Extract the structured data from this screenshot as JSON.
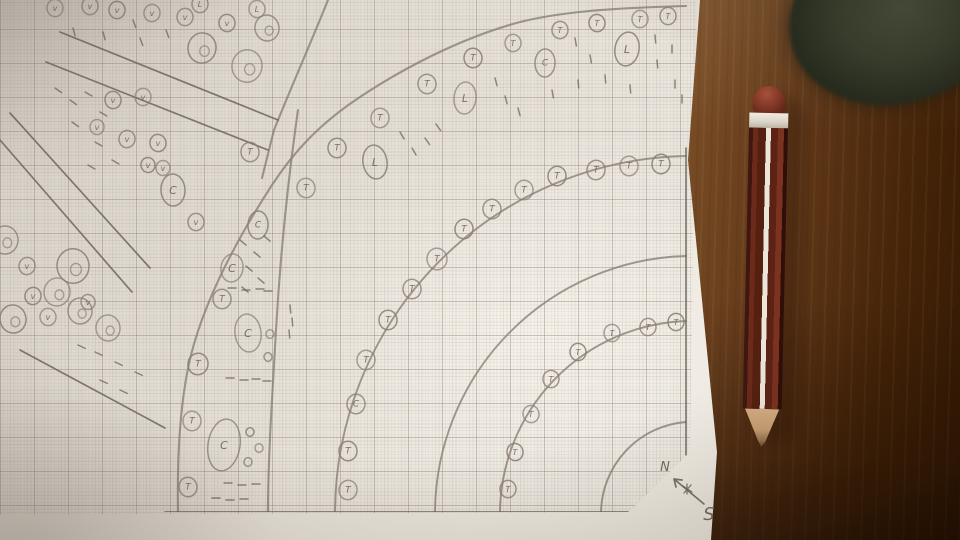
{
  "scene_type": "photo of hand-drawn garden plan on millimeter graph paper with pencil on wooden desk",
  "colors": {
    "pencil_stroke": "#8a8078",
    "pencil_stroke_dark": "#6f665e",
    "letter_color": "#6e655d",
    "paper": "#e7e2d9",
    "wood_light": "#b28a5a",
    "wood_dark": "#3a1d08",
    "pencil_body": "#5c2315",
    "pencil_stripe": "#ece6da",
    "eraser": "#7e3526",
    "wood_tip": "#c79f73"
  },
  "drawing": {
    "compass": {
      "north_label": "N",
      "south_label": "S"
    },
    "fan_center": [
      693,
      514
    ],
    "arc_radii": [
      92,
      193,
      258,
      358
    ],
    "curves": {
      "outer_bed_edge": "M 686 6 C 610 8 560 12 520 22 C 460 38 400 70 357 99 C 320 124 295 150 272 185 C 235 242 205 300 191 355 C 180 400 177 455 178 512",
      "outer_walkway_edge": "M 328 0 C 312 40 290 90 274 130 C 270 146 266 162 262 178",
      "bed_divider": "M 298 110 C 288 180 280 260 276 330 C 272 400 268 460 268 512"
    },
    "lines": [
      [
        60,
        32,
        278,
        120
      ],
      [
        46,
        62,
        268,
        150
      ],
      [
        10,
        113,
        150,
        268
      ],
      [
        0,
        140,
        132,
        292
      ],
      [
        20,
        350,
        165,
        428
      ],
      [
        165,
        512,
        628,
        512
      ],
      [
        686,
        148,
        686,
        455
      ]
    ],
    "plants": [
      [
        380,
        118,
        9,
        "T"
      ],
      [
        427,
        84,
        9,
        "T"
      ],
      [
        473,
        58,
        9,
        "T"
      ],
      [
        513,
        43,
        8,
        "T"
      ],
      [
        560,
        30,
        8,
        "T"
      ],
      [
        597,
        23,
        8,
        "T"
      ],
      [
        640,
        19,
        8,
        "T"
      ],
      [
        668,
        16,
        8,
        "T"
      ],
      [
        337,
        148,
        9,
        "T"
      ],
      [
        306,
        188,
        9,
        "T"
      ],
      [
        222,
        299,
        9,
        "T"
      ],
      [
        198,
        364,
        10,
        "T"
      ],
      [
        192,
        421,
        9,
        "T"
      ],
      [
        188,
        487,
        9,
        "T"
      ],
      [
        375,
        162,
        12,
        "L",
        17
      ],
      [
        465,
        98,
        11,
        "L",
        16
      ],
      [
        545,
        63,
        10,
        "C",
        14
      ],
      [
        627,
        49,
        12,
        "L",
        17
      ],
      [
        248,
        333,
        13,
        "C",
        19
      ],
      [
        224,
        445,
        16,
        "C",
        26
      ],
      [
        258,
        225,
        10,
        "C",
        14
      ],
      [
        270,
        334,
        4,
        ""
      ],
      [
        268,
        357,
        4,
        ""
      ],
      [
        250,
        432,
        4,
        ""
      ],
      [
        259,
        448,
        4,
        ""
      ],
      [
        248,
        462,
        4,
        ""
      ],
      [
        661,
        164,
        9,
        "T"
      ],
      [
        629,
        166,
        9,
        "T"
      ],
      [
        596,
        170,
        9,
        "T"
      ],
      [
        557,
        176,
        9,
        "T"
      ],
      [
        524,
        190,
        9,
        "T"
      ],
      [
        492,
        209,
        9,
        "T"
      ],
      [
        464,
        229,
        9,
        "T"
      ],
      [
        437,
        259,
        10,
        "T"
      ],
      [
        412,
        289,
        9,
        "T"
      ],
      [
        388,
        320,
        9,
        "T"
      ],
      [
        366,
        360,
        9,
        "T"
      ],
      [
        356,
        404,
        9,
        "C"
      ],
      [
        348,
        451,
        9,
        "T"
      ],
      [
        348,
        490,
        9,
        "T"
      ],
      [
        508,
        489,
        8,
        "T"
      ],
      [
        515,
        452,
        8,
        "T"
      ],
      [
        531,
        414,
        8,
        "T"
      ],
      [
        551,
        379,
        8,
        "T"
      ],
      [
        578,
        352,
        8,
        "T"
      ],
      [
        612,
        333,
        8,
        "T"
      ],
      [
        648,
        327,
        8,
        "T"
      ],
      [
        676,
        322,
        8,
        "T"
      ],
      [
        55,
        8,
        8,
        "v"
      ],
      [
        90,
        6,
        8,
        "v"
      ],
      [
        117,
        10,
        8,
        "v"
      ],
      [
        152,
        13,
        8,
        "v"
      ],
      [
        185,
        17,
        8,
        "v"
      ],
      [
        227,
        23,
        8,
        "v"
      ],
      [
        257,
        9,
        8,
        "L"
      ],
      [
        200,
        4,
        8,
        "L"
      ],
      [
        202,
        48,
        14,
        "J"
      ],
      [
        247,
        66,
        15,
        "J"
      ],
      [
        267,
        28,
        12,
        "J"
      ],
      [
        113,
        100,
        8,
        "v"
      ],
      [
        143,
        97,
        8,
        "v"
      ],
      [
        127,
        139,
        8,
        "v"
      ],
      [
        158,
        143,
        8,
        "v"
      ],
      [
        97,
        127,
        7,
        "v"
      ],
      [
        196,
        222,
        8,
        "v"
      ],
      [
        148,
        165,
        7,
        "v"
      ],
      [
        163,
        168,
        7,
        "v"
      ],
      [
        250,
        152,
        9,
        "T"
      ],
      [
        173,
        190,
        12,
        "C",
        16
      ],
      [
        232,
        268,
        11,
        "C",
        14
      ],
      [
        5,
        240,
        13,
        "J"
      ],
      [
        73,
        266,
        16,
        "J"
      ],
      [
        57,
        292,
        13,
        "J"
      ],
      [
        80,
        311,
        12,
        "J"
      ],
      [
        13,
        319,
        13,
        "J"
      ],
      [
        108,
        328,
        12,
        "J"
      ],
      [
        27,
        266,
        8,
        "v"
      ],
      [
        33,
        296,
        8,
        "v"
      ],
      [
        48,
        317,
        8,
        "v"
      ],
      [
        88,
        302,
        7,
        "v"
      ]
    ],
    "dashes": [
      [
        575,
        38,
        80
      ],
      [
        590,
        55,
        80
      ],
      [
        605,
        75,
        85
      ],
      [
        578,
        80,
        85
      ],
      [
        552,
        90,
        80
      ],
      [
        655,
        35,
        85
      ],
      [
        657,
        60,
        85
      ],
      [
        672,
        45,
        90
      ],
      [
        675,
        80,
        90
      ],
      [
        682,
        95,
        90
      ],
      [
        630,
        85,
        85
      ],
      [
        495,
        78,
        75
      ],
      [
        505,
        96,
        75
      ],
      [
        518,
        108,
        75
      ],
      [
        400,
        132,
        60
      ],
      [
        412,
        148,
        60
      ],
      [
        425,
        138,
        55
      ],
      [
        436,
        124,
        55
      ],
      [
        240,
        240,
        40
      ],
      [
        254,
        252,
        40
      ],
      [
        264,
        236,
        40
      ],
      [
        246,
        266,
        40
      ],
      [
        258,
        278,
        40
      ],
      [
        242,
        287,
        40
      ],
      [
        290,
        305,
        85
      ],
      [
        292,
        318,
        85
      ],
      [
        289,
        330,
        85
      ],
      [
        228,
        288,
        0
      ],
      [
        242,
        290,
        0
      ],
      [
        256,
        289,
        0
      ],
      [
        264,
        291,
        0
      ],
      [
        226,
        378,
        0
      ],
      [
        240,
        380,
        0
      ],
      [
        252,
        379,
        0
      ],
      [
        263,
        381,
        0
      ],
      [
        224,
        483,
        0
      ],
      [
        238,
        485,
        0
      ],
      [
        252,
        484,
        0
      ],
      [
        212,
        498,
        0
      ],
      [
        226,
        500,
        0
      ],
      [
        240,
        499,
        0
      ],
      [
        73,
        28,
        75
      ],
      [
        103,
        32,
        75
      ],
      [
        133,
        20,
        70
      ],
      [
        140,
        38,
        70
      ],
      [
        166,
        30,
        70
      ],
      [
        55,
        88,
        35
      ],
      [
        70,
        100,
        35
      ],
      [
        85,
        92,
        30
      ],
      [
        100,
        112,
        30
      ],
      [
        72,
        122,
        35
      ],
      [
        95,
        142,
        30
      ],
      [
        112,
        160,
        30
      ],
      [
        88,
        165,
        30
      ],
      [
        95,
        352,
        25
      ],
      [
        115,
        362,
        25
      ],
      [
        135,
        372,
        25
      ],
      [
        100,
        380,
        25
      ],
      [
        120,
        390,
        25
      ],
      [
        78,
        345,
        25
      ]
    ]
  }
}
